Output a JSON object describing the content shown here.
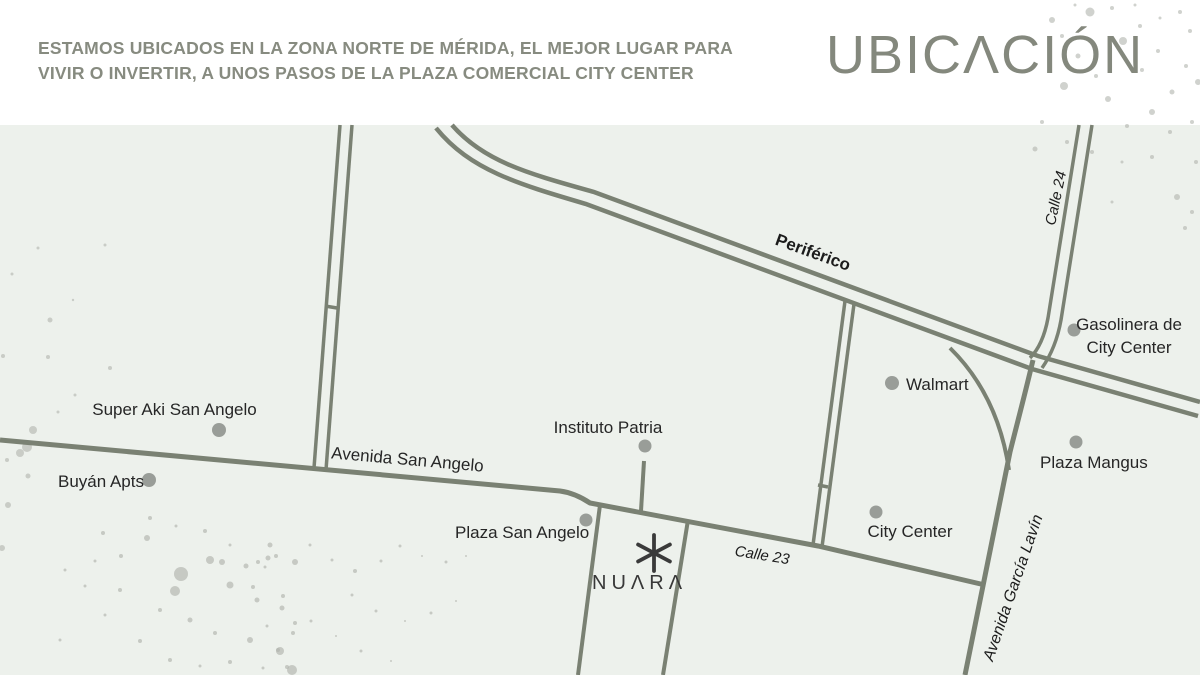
{
  "header": {
    "tagline": "ESTAMOS UBICADOS EN LA ZONA NORTE DE MÉRIDA, EL MEJOR LUGAR PARA VIVIR O INVERTIR, A UNOS PASOS DE LA PLAZA COMERCIAL CITY CENTER",
    "tagline_lines": [
      "ESTAMOS UBICADOS EN LA ZONA NORTE DE MÉRIDA, EL MEJOR LUGAR PARA",
      "VIVIR O INVERTIR, A UNOS PASOS DE LA PLAZA COMERCIAL CITY CENTER"
    ],
    "title": "UBICACIÓN",
    "title_display": "UBICΛCIÓN"
  },
  "map": {
    "roads": {
      "periferico": "Periférico",
      "calle_24": "Calle 24",
      "avenida_san_angelo": "Avenida San Angelo",
      "calle_23": "Calle 23",
      "avenida_garcia_lavin": "Avenida García Lavín"
    },
    "places": {
      "super_aki": {
        "label": "Super Aki San Angelo"
      },
      "buyan_apts": {
        "label": "Buyán Apts"
      },
      "instituto_patria": {
        "label": "Instituto Patria"
      },
      "plaza_san_angelo": {
        "label": "Plaza San Angelo"
      },
      "walmart": {
        "label": "Walmart"
      },
      "gasolinera_city_center": {
        "label": "Gasolinera de City Center"
      },
      "plaza_mangus": {
        "label": "Plaza Mangus"
      },
      "city_center": {
        "label": "City Center"
      }
    },
    "brand": {
      "name": "NUARA",
      "name_display": "NUΛRΛ"
    }
  },
  "colors": {
    "map_background": "#edf1ec",
    "road": "#7a8173",
    "poi_marker": "#999d98",
    "heading_text": "#878b80",
    "label_text": "#262626",
    "brand_text": "#383838",
    "splatter": "#b0b4ae"
  }
}
